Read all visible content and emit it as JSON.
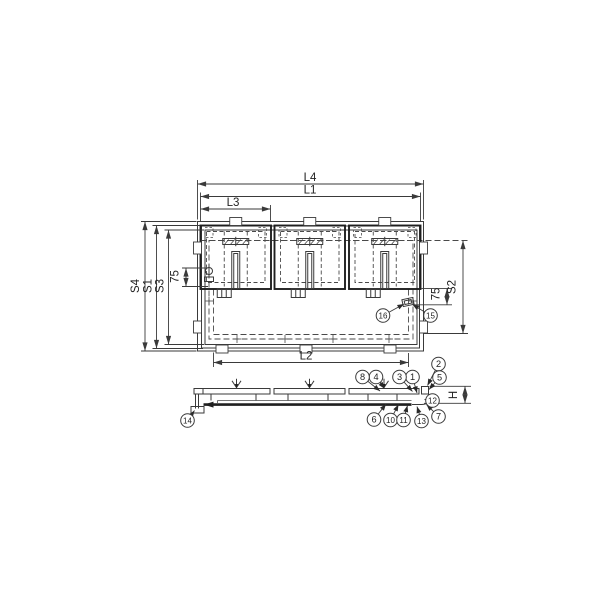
{
  "labels": {
    "L4": "L4",
    "L1": "L1",
    "L3": "L3",
    "L2": "L2",
    "S4": "S4",
    "S1": "S1",
    "S3": "S3",
    "S2": "S2",
    "offset_left": "75",
    "offset_right": "75",
    "H": "H"
  },
  "callouts": [
    {
      "num": "1"
    },
    {
      "num": "2"
    },
    {
      "num": "3"
    },
    {
      "num": "4"
    },
    {
      "num": "5"
    },
    {
      "num": "6"
    },
    {
      "num": "7"
    },
    {
      "num": "8"
    },
    {
      "num": "10"
    },
    {
      "num": "11"
    },
    {
      "num": "12"
    },
    {
      "num": "13"
    },
    {
      "num": "14"
    },
    {
      "num": "15"
    },
    {
      "num": "16"
    }
  ]
}
